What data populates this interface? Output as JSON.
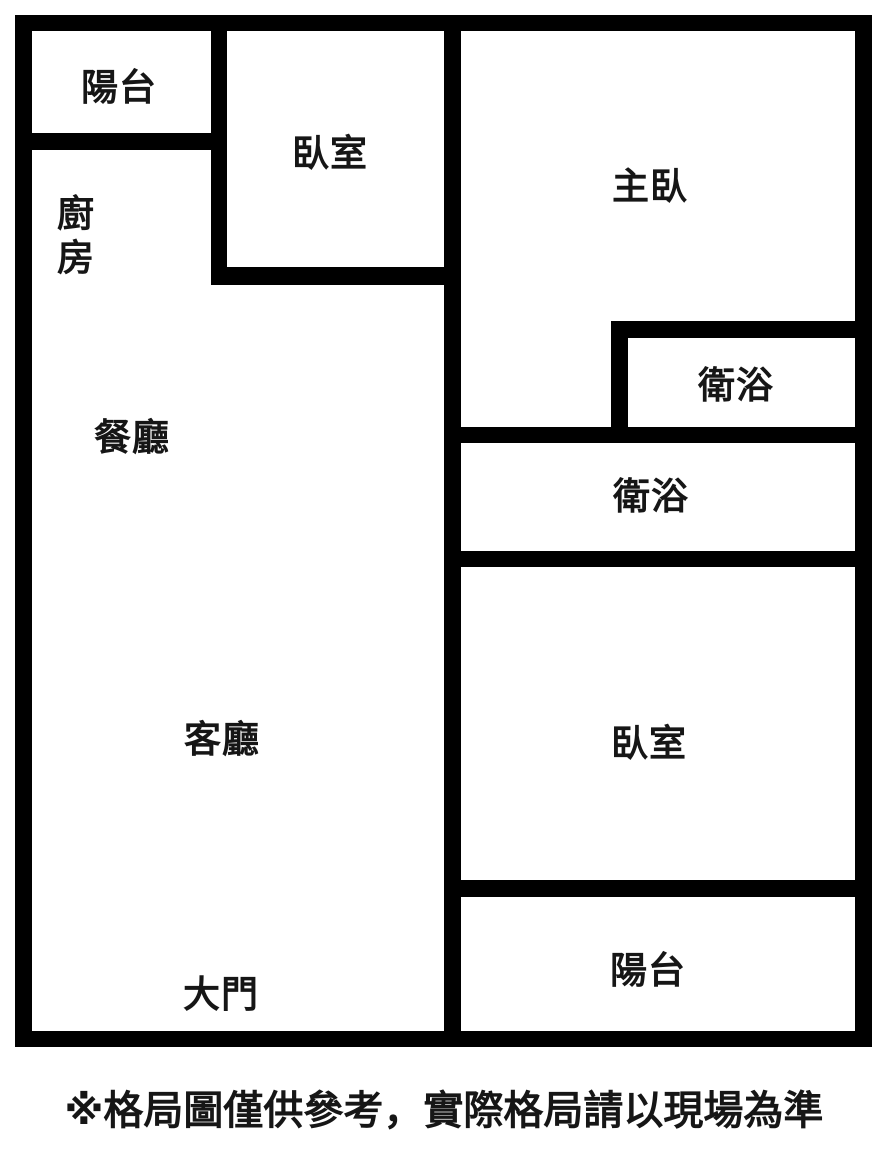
{
  "canvas": {
    "width": 888,
    "height": 1150,
    "background_color": "#ffffff",
    "wall_color": "#000000",
    "text_color": "#161616"
  },
  "floor_plan": {
    "walls": [
      {
        "id": "outer-top",
        "x": 15,
        "y": 15,
        "w": 857,
        "h": 16
      },
      {
        "id": "outer-left",
        "x": 15,
        "y": 15,
        "w": 17,
        "h": 1032
      },
      {
        "id": "outer-right",
        "x": 855,
        "y": 15,
        "w": 17,
        "h": 1032
      },
      {
        "id": "outer-bottom",
        "x": 15,
        "y": 1031,
        "w": 857,
        "h": 16
      },
      {
        "id": "center-vertical",
        "x": 444,
        "y": 15,
        "w": 17,
        "h": 1032
      },
      {
        "id": "balcony-tl-bottom",
        "x": 15,
        "y": 133,
        "w": 212,
        "h": 17
      },
      {
        "id": "bedroom-tm-left",
        "x": 211,
        "y": 15,
        "w": 16,
        "h": 270
      },
      {
        "id": "bedroom-tm-bottom",
        "x": 211,
        "y": 267,
        "w": 250,
        "h": 18
      },
      {
        "id": "bath-master-top",
        "x": 611,
        "y": 321,
        "w": 261,
        "h": 17
      },
      {
        "id": "bath-master-left",
        "x": 611,
        "y": 321,
        "w": 17,
        "h": 122
      },
      {
        "id": "bath-main-top",
        "x": 444,
        "y": 427,
        "w": 428,
        "h": 16
      },
      {
        "id": "bath-main-bottom",
        "x": 444,
        "y": 551,
        "w": 428,
        "h": 16
      },
      {
        "id": "bedroom-br-bottom",
        "x": 444,
        "y": 880,
        "w": 428,
        "h": 17
      }
    ],
    "rooms": [
      {
        "id": "balcony-top-left",
        "label": "陽台",
        "cx": 119,
        "cy": 88
      },
      {
        "id": "bedroom-top",
        "label": "臥室",
        "cx": 330,
        "cy": 154
      },
      {
        "id": "master-bedroom",
        "label": "主臥",
        "cx": 650,
        "cy": 187
      },
      {
        "id": "kitchen",
        "label": "廚\n房",
        "cx": 76,
        "cy": 236
      },
      {
        "id": "bathroom-master",
        "label": "衛浴",
        "cx": 736,
        "cy": 386
      },
      {
        "id": "dining-room",
        "label": "餐廳",
        "cx": 132,
        "cy": 438
      },
      {
        "id": "bathroom-main",
        "label": "衛浴",
        "cx": 651,
        "cy": 497
      },
      {
        "id": "living-room",
        "label": "客廳",
        "cx": 222,
        "cy": 740
      },
      {
        "id": "bedroom-right",
        "label": "臥室",
        "cx": 649,
        "cy": 744
      },
      {
        "id": "balcony-bottom",
        "label": "陽台",
        "cx": 648,
        "cy": 971
      },
      {
        "id": "main-door",
        "label": "大門",
        "cx": 221,
        "cy": 995
      }
    ]
  },
  "disclaimer": {
    "text": "※格局圖僅供參考，實際格局請以現場為準"
  }
}
